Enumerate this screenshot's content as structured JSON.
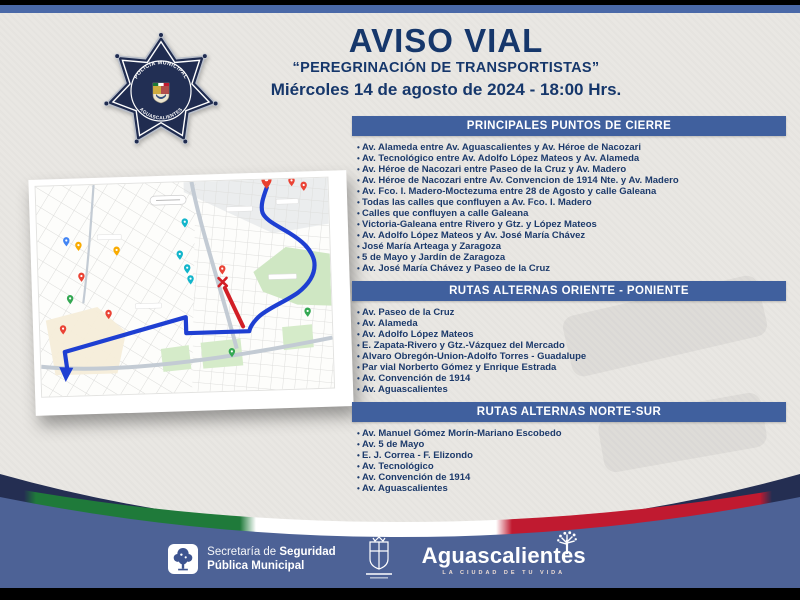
{
  "page": {
    "title": "AVISO VIAL",
    "subtitle": "“PEREGRINACIÓN DE TRANSPORTISTAS”",
    "datetime": "Miércoles 14 de agosto de 2024 - 18:00 Hrs."
  },
  "badge": {
    "top_text": "POLICÍA MUNICIPAL",
    "bottom_text": "AGUASCALIENTES"
  },
  "sections": [
    {
      "header": "PRINCIPALES PUNTOS DE CIERRE",
      "items": [
        "Av. Alameda entre Av. Aguascalientes y Av. Héroe de Nacozari",
        "Av. Tecnológico entre Av. Adolfo López Mateos y Av. Alameda",
        "Av. Héroe de Nacozari entre Paseo de la Cruz y Av. Madero",
        "Av. Héroe de Nacozari entre Av. Convencion de 1914 Nte. y Av. Madero",
        "Av. Fco. I. Madero-Moctezuma entre 28 de Agosto y calle Galeana",
        "Todas las calles que confluyen a Av. Fco. I. Madero",
        "Calles que confluyen a calle Galeana",
        "Victoria-Galeana entre Rivero y Gtz. y López Mateos",
        "Av. Adolfo López Mateos y Av. José María Chávez",
        "José María Arteaga y Zaragoza",
        "5 de Mayo y Jardín de Zaragoza",
        "Av. José María Chávez y Paseo de la Cruz"
      ]
    },
    {
      "header": "RUTAS ALTERNAS ORIENTE - PONIENTE",
      "items": [
        "Av. Paseo de la Cruz",
        "Av. Alameda",
        "Av. Adolfo López Mateos",
        "E. Zapata-Rivero y Gtz.-Vázquez del Mercado",
        "Alvaro Obregón-Union-Adolfo Torres - Guadalupe",
        "Par vial Norberto Gómez y Enrique Estrada",
        "Av. Convención de 1914",
        "Av. Aguascalientes"
      ]
    },
    {
      "header": "RUTAS ALTERNAS NORTE-SUR",
      "items": [
        "Av. Manuel Gómez Morín-Mariano Escobedo",
        "Av. 5 de Mayo",
        "E. J. Correa - F. Elizondo",
        "Av. Tecnológico",
        "Av. Convención de 1914",
        "Av. Aguascalientes"
      ]
    }
  ],
  "footer": {
    "secretaria": {
      "line1_light": "Secretaría de ",
      "line1_bold": "Seguridad",
      "line2_bold": "Pública Municipal"
    },
    "city": {
      "name": "Aguascalientes",
      "tagline": "LA CIUDAD DE TU VIDA"
    }
  },
  "colors": {
    "title_navy": "#16376b",
    "section_header_blue": "#40609e",
    "footer_blue": "#4d6296",
    "top_stripe_blue": "#4a69a8",
    "flag_green": "#1f7a3a",
    "flag_red": "#c01a30",
    "arc_navy": "#242e52",
    "route_blue": "#1e3fd2",
    "closure_red": "#d21f26",
    "paper": "#e9e7e3"
  }
}
